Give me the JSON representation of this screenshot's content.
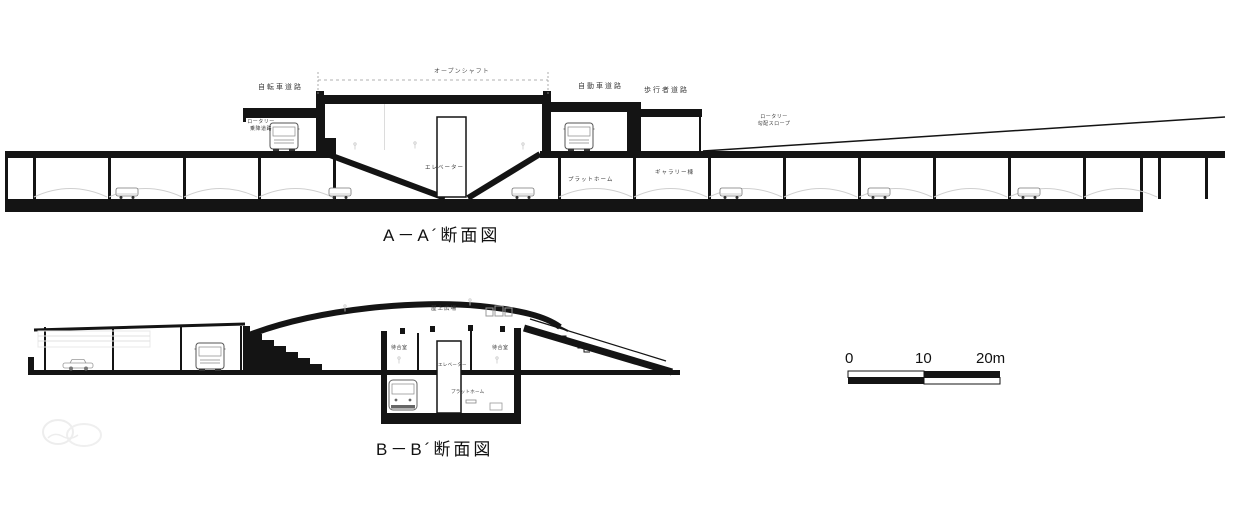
{
  "colors": {
    "ink": "#141414",
    "detail": "#c9c9c9",
    "faint": "#ededed"
  },
  "section_a": {
    "title": "A－A´断面図",
    "labels": {
      "bicycle_road": "自転車道路",
      "open_shaft": "オープンシャフト",
      "car_road": "自動車道路",
      "pedestrian_road": "歩行者道路",
      "rotary_boarding_line1": "ロータリー",
      "rotary_boarding_line2": "乗降道路",
      "rotary_slope_line1": "ロータリー",
      "rotary_slope_line2": "勾配スロープ",
      "elevator": "エレベーター",
      "platform": "プラットホーム",
      "gallery": "ギャラリー棟"
    }
  },
  "section_b": {
    "title": "B－B´断面図",
    "labels": {
      "rooftop_plaza": "屋上広場",
      "waiting_room_left": "待合室",
      "waiting_room_right": "待合室",
      "elevator": "エレベーター",
      "platform": "プラットホーム"
    }
  },
  "scale_bar": {
    "start": "0",
    "mid": "10",
    "end": "20m"
  }
}
